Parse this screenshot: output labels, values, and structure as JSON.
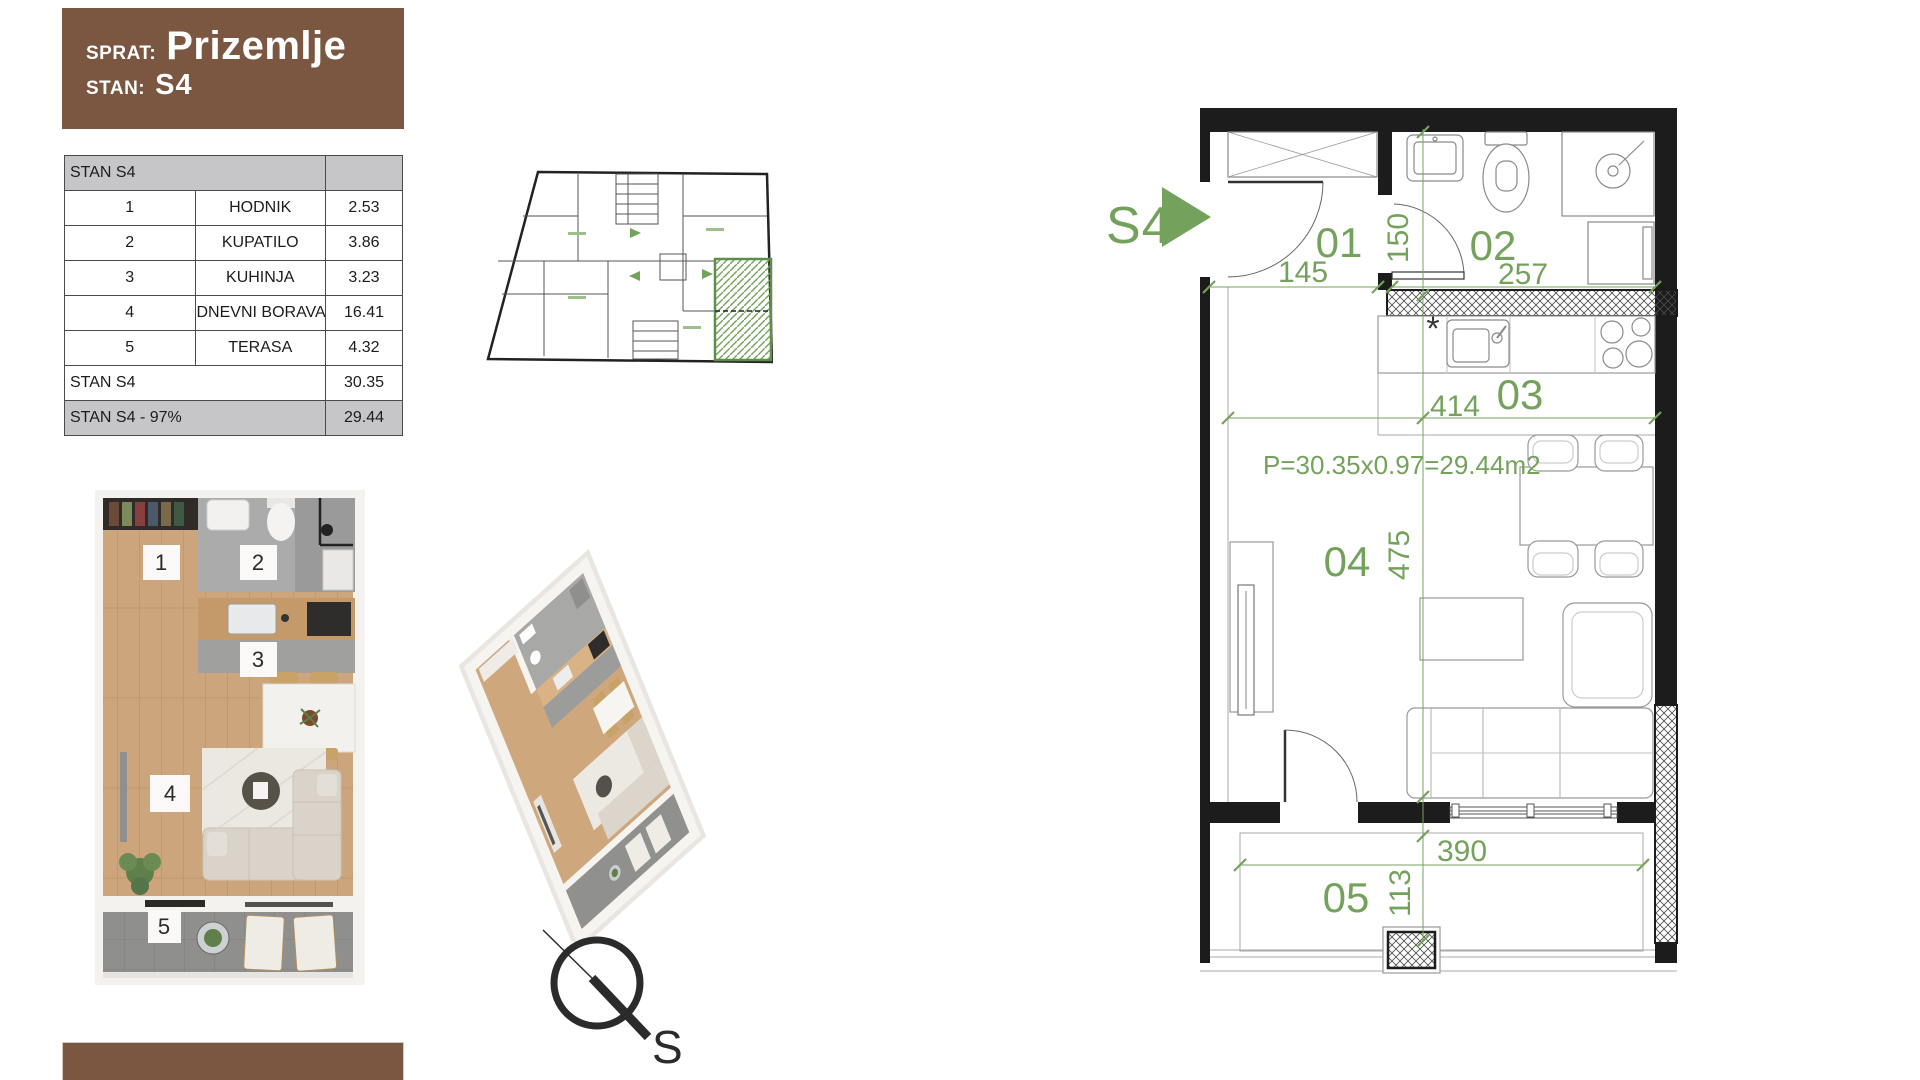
{
  "header": {
    "sprat_label": "SPRAT:",
    "sprat_value": "Prizemlje",
    "stan_label": "STAN:",
    "stan_value": "S4"
  },
  "area_table": {
    "title": "STAN S4",
    "rows": [
      {
        "num": "1",
        "name": "HODNIK",
        "value": "2.53"
      },
      {
        "num": "2",
        "name": "KUPATILO",
        "value": "3.86"
      },
      {
        "num": "3",
        "name": "KUHINJA",
        "value": "3.23"
      },
      {
        "num": "4",
        "name": "DNEVNI BORAVAK",
        "value": "16.41"
      },
      {
        "num": "5",
        "name": "TERASA",
        "value": "4.32"
      }
    ],
    "total": {
      "label": "STAN S4",
      "value": "30.35"
    },
    "reduced": {
      "label": "STAN S4 - 97%",
      "value": "29.44"
    }
  },
  "floor_plan": {
    "unit_label": "S4",
    "area_formula": "P=30.35x0.97=29.44m2",
    "note_symbol": "*",
    "room_numbers": {
      "hall": "01",
      "bath": "02",
      "kitchen": "03",
      "living": "04",
      "terrace": "05"
    },
    "dimensions": {
      "hall_width": "145",
      "hall_depth": "150",
      "bath_width": "257",
      "main_width": "414",
      "living_depth": "475",
      "terrace_width": "390",
      "terrace_depth": "113"
    }
  },
  "render_labels": {
    "r1": "1",
    "r2": "2",
    "r3": "3",
    "r4": "4",
    "r5": "5"
  },
  "compass": {
    "south_label": "S"
  },
  "colors": {
    "brand_brown": "#7b5640",
    "accent_green": "#74a25c",
    "table_header_gray": "#c6c6c8",
    "wall_black": "#1c1c1c"
  }
}
